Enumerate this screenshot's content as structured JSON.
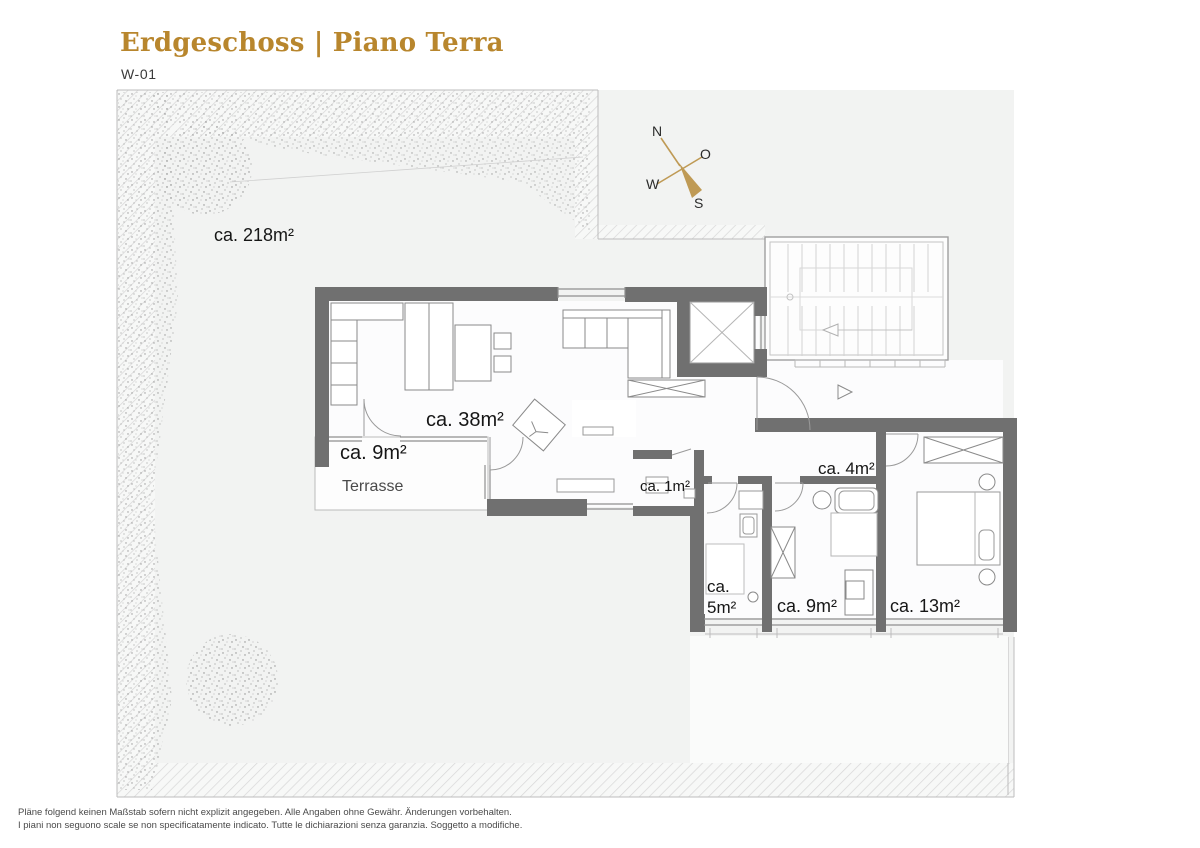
{
  "header": {
    "title": "Erdgeschoss | Piano Terra",
    "subtitle": "W-01"
  },
  "compass": {
    "north": "N",
    "east": "O",
    "south": "S",
    "west": "W"
  },
  "rooms": {
    "garden_area": "ca. 218m²",
    "living_area": "ca. 38m²",
    "terrace_area": "ca. 9m²",
    "terrace_name": "Terrasse",
    "storage_area": "ca. 1m²",
    "bath_large_area": "ca. 4m²",
    "bath_small_line1": "ca.",
    "bath_small_line2": "5m²",
    "bedroom_small_area": "ca. 9m²",
    "bedroom_large_area": "ca. 13m²"
  },
  "footer": {
    "line1": "Pläne folgend keinen Maßstab sofern nicht explizit angegeben. Alle Angaben ohne Gewähr. Änderungen vorbehalten.",
    "line2": "I piani non seguono scale se non specificatamente indicato. Tutte le dichiarazioni senza garanzia. Soggetto a modifiche."
  },
  "colors": {
    "accent_gold": "#B8862D",
    "wall_gray": "#707070",
    "garden_fill": "#F2F3F2"
  }
}
